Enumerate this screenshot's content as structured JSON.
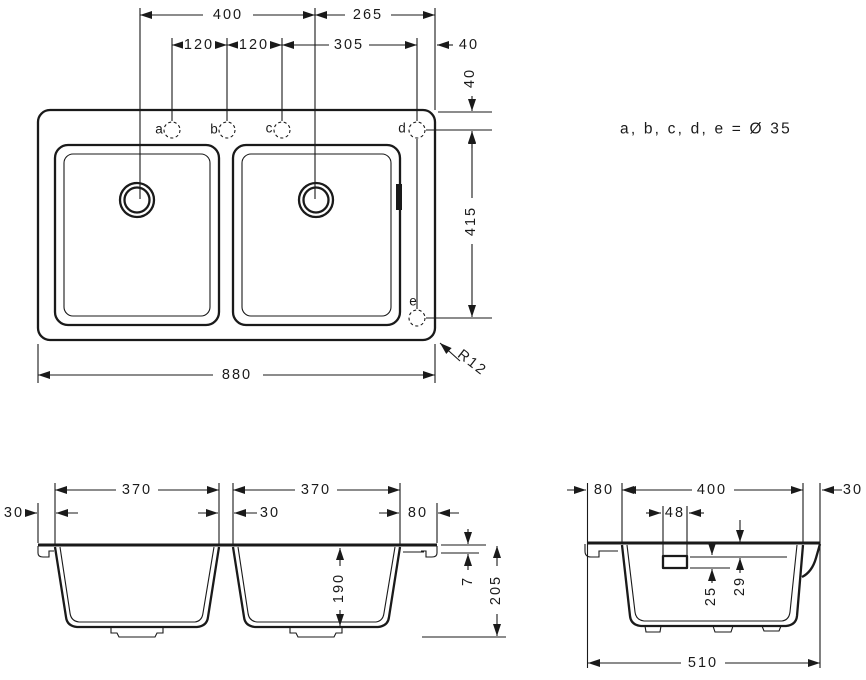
{
  "colors": {
    "line": "#1a1a1a",
    "background": "#ffffff"
  },
  "note": {
    "text": "a, b, c, d, e = Ø 35"
  },
  "top_view": {
    "holes": {
      "a": "a",
      "b": "b",
      "c": "c",
      "d": "d",
      "e": "e"
    },
    "dims": {
      "top_400": "400",
      "top_265": "265",
      "row2_120_1": "120",
      "row2_120_2": "120",
      "row2_305": "305",
      "row2_40": "40",
      "right_40": "40",
      "right_415": "415",
      "bottom_880": "880",
      "radius": "R12"
    }
  },
  "front_view": {
    "dims": {
      "bowl_left_370": "370",
      "bowl_right_370": "370",
      "left_30": "30",
      "divider_30": "30",
      "ledge_80": "80",
      "rim_7": "7",
      "depth_190": "190",
      "height_205": "205"
    }
  },
  "side_view": {
    "dims": {
      "front_80": "80",
      "bowl_400": "400",
      "back_30": "30",
      "overflow_48": "48",
      "overflow_h_25": "25",
      "overflow_top_29": "29",
      "depth_510": "510"
    }
  }
}
